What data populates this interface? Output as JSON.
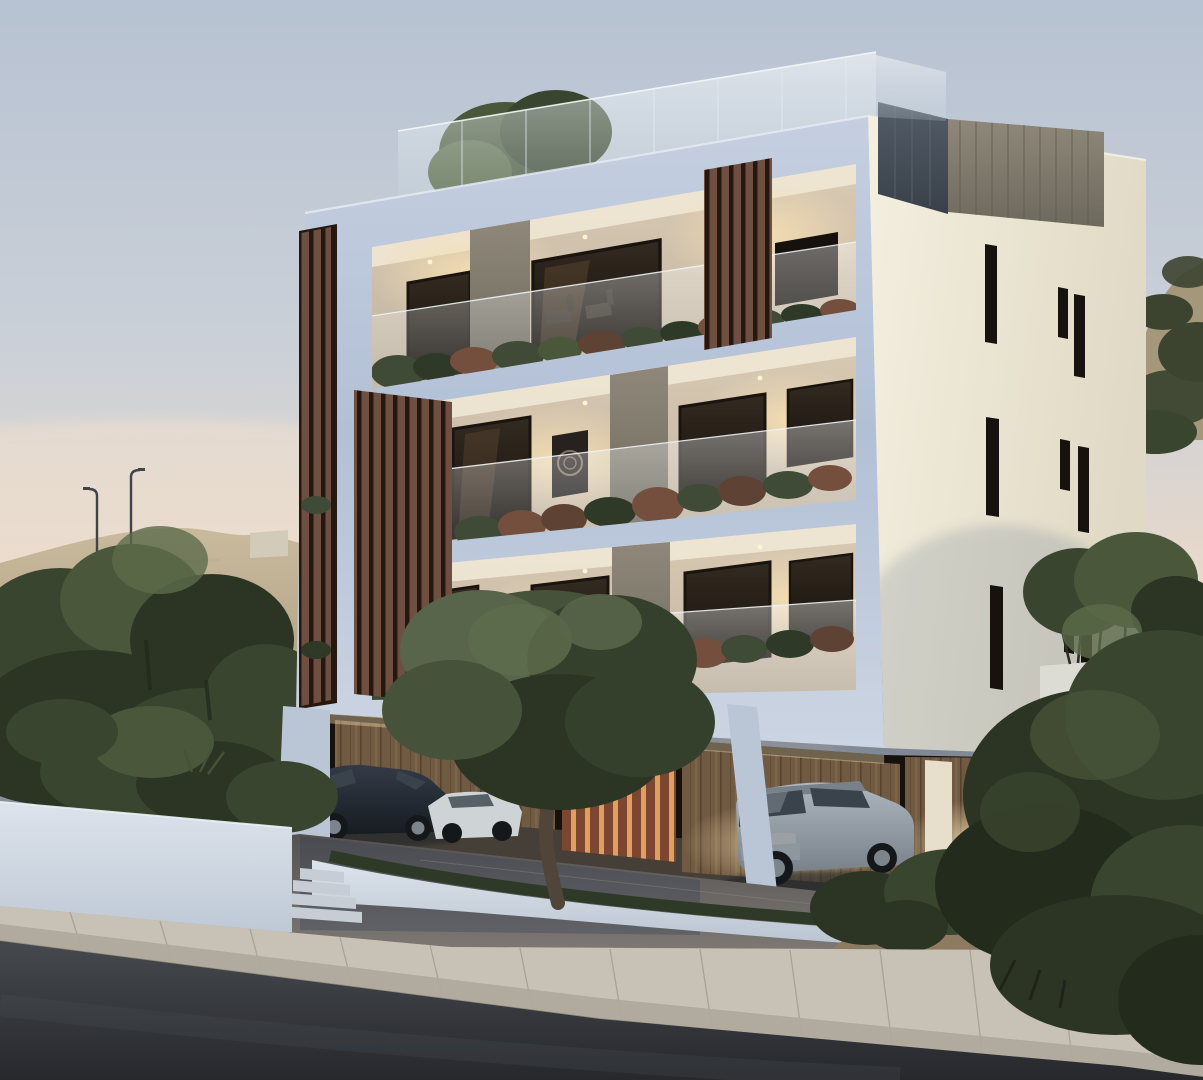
{
  "scene": {
    "subject": "Modern three-storey apartment building with roof terrace at dusk",
    "type": "architectural exterior 3D rendering",
    "time_of_day": "dusk",
    "setting": "hillside street in a dry Mediterranean landscape",
    "objects": [
      "apartment building with white frame facade",
      "roof terrace with frameless glass railing and small tree",
      "dark grey roof stair core",
      "vertical timber louver screens",
      "three balcony floors with warm interior lighting",
      "glass balcony railings with planted borders",
      "narrow slit windows on cream side wall",
      "covered ground-floor parking with timber walls",
      "dark sedan car",
      "white car",
      "silver SUV",
      "olive tree in curved white planter",
      "stepped white landscape planters with shrubs",
      "street lamps on rocky hill",
      "concrete sidewalk with curb",
      "sloping asphalt road",
      "trees and dry scrub"
    ]
  },
  "colors": {
    "sky_top": "#b7c2d2",
    "sky_mid": "#ccd1d8",
    "sky_low": "#e6d8cb",
    "sky_glow": "#f1e1cf",
    "hill": "#c9b99d",
    "hill_dark": "#ac9c80",
    "hill_right": "#a5977a",
    "scrub": "#3c4430",
    "wall_block": "#d3cbb9",
    "lamp": "#3f444b",
    "tree_dark": "#2c3424",
    "tree_mid": "#39452e",
    "tree_light": "#4a573a",
    "tree_high": "#5d6c4b",
    "olive_dark": "#35402c",
    "olive_mid": "#46523a",
    "olive_light": "#58654a",
    "trunk": "#51453a",
    "facade_top": "#c5cfe0",
    "facade_mid": "#b2c0d6",
    "facade_low": "#ccd5e2",
    "white_trim": "#e6ecf4",
    "side_light": "#f4efdf",
    "side_dark": "#e0d9c5",
    "slit": "#17120d",
    "core_left1": "#535d68",
    "core_left2": "#394049",
    "core_right1": "#8f887a",
    "core_right2": "#6e695d",
    "core_streak": "#5e594e",
    "interior1": "#d9cab3",
    "interior2": "#c1b3a1",
    "ceiling": "#efe7d5",
    "glow": "#f6dfb2",
    "window1": "#332a20",
    "window2": "#16110c",
    "win_warm": "#70563a",
    "wood1": "#93826d",
    "wood2": "#6d5f51",
    "louver": "#6e4f41",
    "louver_dark": "#241811",
    "louver_red": "#7c4630",
    "louver_red_gap": "#dfa05f",
    "plank_base": "#715a42",
    "plank_line": "#55422f",
    "plank_hi": "#8a6f50",
    "plant_green": "#3f4b36",
    "plant_green2": "#2e3a27",
    "plant_red": "#754f3d",
    "plant_red2": "#5e4234",
    "pillar": "#bac6d5",
    "pillar_warm": "#e7decb",
    "grille": "#3b342a",
    "bmw1": "#333b47",
    "bmw2": "#171b21",
    "car_glass": "#3a424b",
    "white_car": "#ced3d6",
    "suv1": "#aeb7be",
    "suv2": "#788189",
    "rim": "#7d858c",
    "tyre": "#15181b",
    "taillight": "#cf4433",
    "taillight_glow": "#ff7a5e",
    "suv_tail": "#6e2a24",
    "plate": "#cfd4d6",
    "planter1": "#dde3eb",
    "planter2": "#b9c4d1",
    "step": "#c6cdd5",
    "drive1": "#7d7874",
    "drive2": "#555250",
    "drive_warm": "#b2956c",
    "drive_shadow": "#2f3c52",
    "walk1": "#c7c2b5",
    "walk2": "#a9a498",
    "walk_joint": "#9a9487",
    "road1": "#46494e",
    "road2": "#26282c",
    "shadow": "#1c2026",
    "shadow_blue": "#5b6f8a",
    "mound": "#8d7b60"
  }
}
